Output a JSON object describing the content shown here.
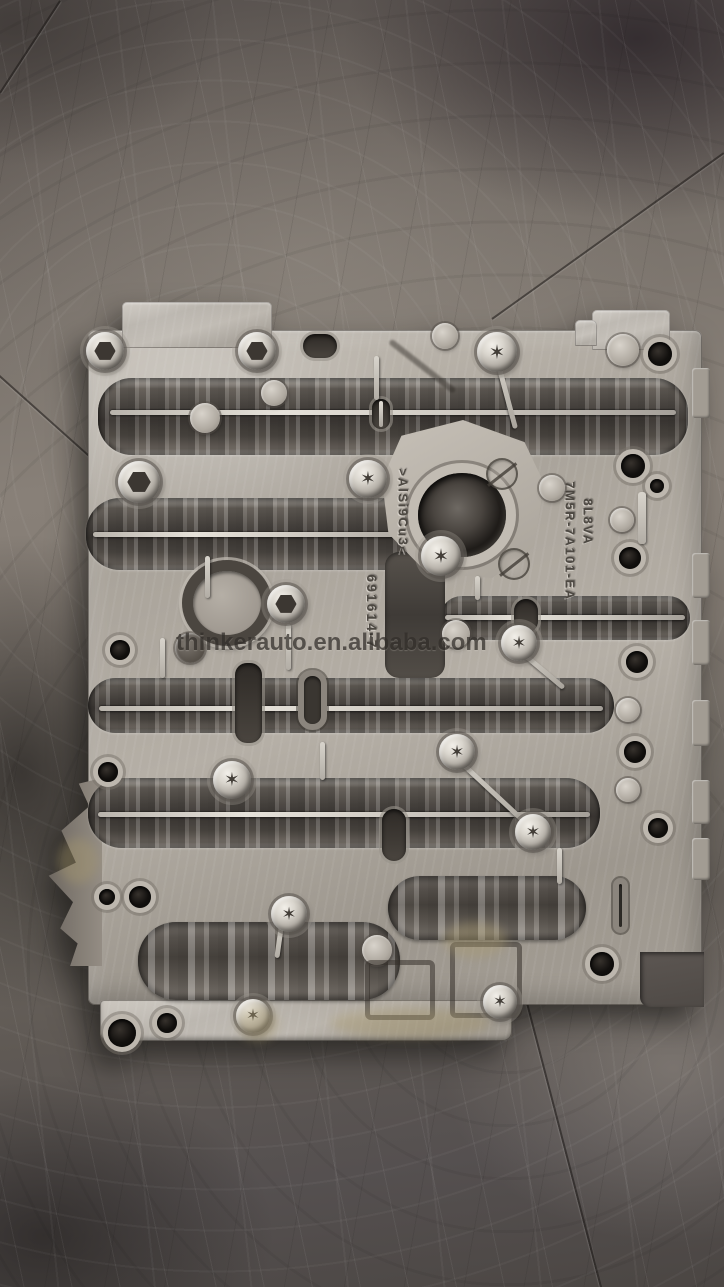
{
  "scene": {
    "subject": "Aluminum automatic transmission valve body casting lying on a scratched concrete floor",
    "watermark_text": "thinkerauto.en.alibaba.com"
  },
  "part_markings": {
    "alloy": ">AlSi9Cu3<",
    "casting_code": "8L8VA",
    "part_number": "7M5R-7A101-EA",
    "serial": "691614-7"
  },
  "colors": {
    "aluminum_deck": "#b3ada4",
    "channel_dark": "#4e4a45",
    "floor_gray": "#7b746d",
    "hole_black": "#12100e",
    "screw_silver": "#d9d5cd",
    "stain_brass": "#a99a6e",
    "watermark_gray": "#322e2a"
  }
}
